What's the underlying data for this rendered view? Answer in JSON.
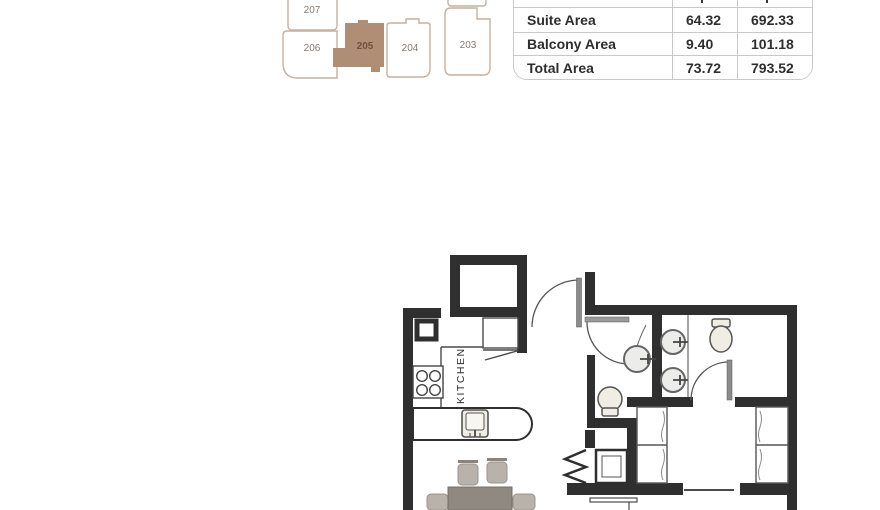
{
  "keyplan": {
    "units": [
      {
        "id": "207",
        "highlighted": false
      },
      {
        "id": "206",
        "highlighted": false
      },
      {
        "id": "205",
        "highlighted": true
      },
      {
        "id": "204",
        "highlighted": false
      },
      {
        "id": "203",
        "highlighted": false
      }
    ],
    "highlight_color": "#b08d75",
    "outline_color": "#c7b09e",
    "label_color": "#847a71",
    "highlight_label_color": "#6f513d"
  },
  "area_table": {
    "columns": [
      "Sq.m",
      "Sq.ft"
    ],
    "rows": [
      {
        "label": "Suite Area",
        "sqm": "64.32",
        "sqft": "692.33"
      },
      {
        "label": "Balcony Area",
        "sqm": "9.40",
        "sqft": "101.18"
      },
      {
        "label": "Total Area",
        "sqm": "73.72",
        "sqft": "793.52"
      }
    ]
  },
  "floorplan": {
    "room_labels": [
      {
        "text": "KITCHEN"
      }
    ],
    "wall_color": "#2f2f2f",
    "fixture_fill": "#f0ede5",
    "furniture_color": "#b9b2aa",
    "symbols": [
      "entry-door",
      "powder-room-door",
      "bathroom-door",
      "accordion-door",
      "stove",
      "kitchen-sink",
      "kitchen-counter",
      "round-sink",
      "vanity-sink",
      "toilet",
      "washer",
      "wardrobe",
      "closet",
      "dining-table",
      "chair",
      "balcony-railing"
    ]
  }
}
